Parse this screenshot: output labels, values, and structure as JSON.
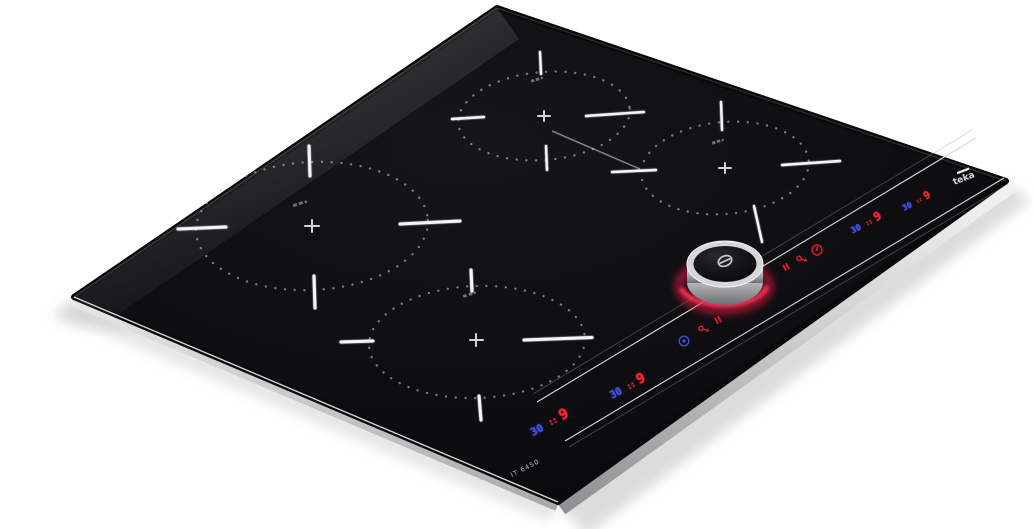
{
  "product": {
    "brand": "teka",
    "model": "IT 6450",
    "description": "black glass induction hob, four cooking zones, front control strip with magnetic knob"
  },
  "displays": [
    {
      "timer": "30",
      "separator": "::",
      "power": "9"
    },
    {
      "timer": "30",
      "separator": "::",
      "power": "9"
    },
    {
      "timer": "30",
      "separator": "::",
      "power": "9"
    },
    {
      "timer": "30",
      "separator": "::",
      "power": "9"
    }
  ],
  "knob": {
    "symbol": "power",
    "glow_color": "#ff1e46"
  },
  "touch_icons_left": [
    "timer-icon",
    "lock-icon",
    "pause-icon"
  ],
  "touch_icons_right": [
    "pause-icon",
    "lock-icon",
    "timer-icon"
  ],
  "colors": {
    "background": "#ffffff",
    "glass": "#0b0b0e",
    "bevel_silver": "#c9c9c9",
    "led_red": "#ff2433",
    "led_blue": "#4156f0",
    "knob_glow": "#ff1e46",
    "zone_marking": "#f4f4f6"
  }
}
